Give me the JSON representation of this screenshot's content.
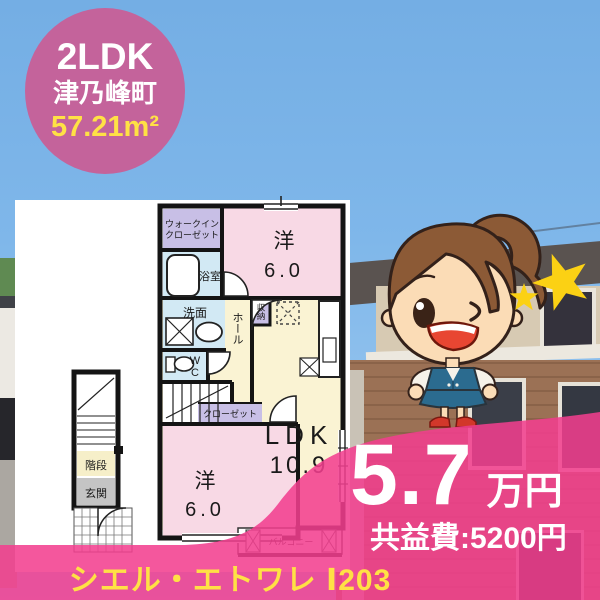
{
  "badge": {
    "layout_type": "2LDK",
    "town": "津乃峰町",
    "area": "57.21m²"
  },
  "floorplan": {
    "walkin_line1": "ウォークイン",
    "walkin_line2": "クローゼット",
    "bath": "浴室",
    "washroom": "洗面",
    "wc": "WC",
    "hall": "ホール",
    "storage": "収納",
    "room_top": "洋",
    "room_top_size": "6.0",
    "ldk": "LDK",
    "ldk_size": "10.9",
    "closet": "クローゼット",
    "room_bottom": "洋",
    "room_bottom_size": "6.0",
    "stairs": "階段",
    "entrance": "玄関",
    "balcony": "バルコニー"
  },
  "price": {
    "amount": "5.7",
    "unit": "万円",
    "common_fee": "共益費:5200円"
  },
  "property_name": "シエル・エトワレ Ⅰ203",
  "colors": {
    "brand_pink": "#F23E8E",
    "badge_pink": "#C4639B",
    "accent_yellow": "#FFE145",
    "room_pink": "#F8D9E5",
    "room_cream": "#FAF3D3",
    "room_blue": "#D2E9F4",
    "room_lavender": "#C8BFE6",
    "star_yellow": "#FBD114"
  }
}
